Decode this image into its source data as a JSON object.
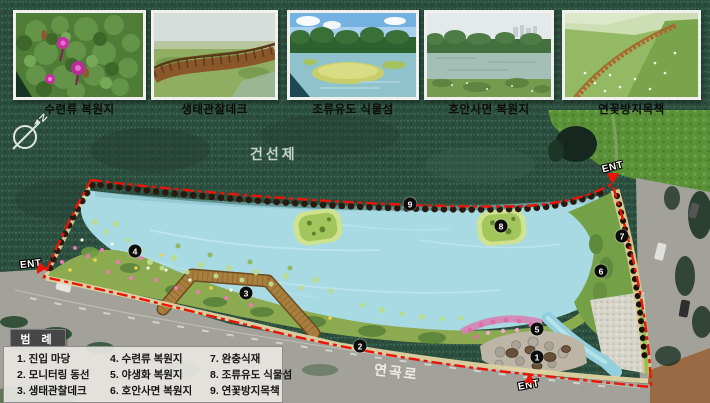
{
  "photos": [
    {
      "caption": "수련류 복원지"
    },
    {
      "caption": "생태관찰데크"
    },
    {
      "caption": "조류유도 식물섬"
    },
    {
      "caption": "호안사면 복원지"
    },
    {
      "caption": "연꽃방지목책"
    }
  ],
  "map": {
    "area_label": "건선제",
    "road_label": "연곡로",
    "entrance_label": "ENT",
    "compass_n": "N",
    "markers": [
      "1",
      "2",
      "3",
      "4",
      "5",
      "6",
      "7",
      "8",
      "9"
    ]
  },
  "legend": {
    "title": "범 례",
    "items": [
      "1. 진입 마당",
      "2. 모니터링 동선",
      "3. 생태관찰데크",
      "4. 수련류 복원지",
      "5. 야생화 복원지",
      "6. 호안사면 복원지",
      "7. 완충식재",
      "8. 조류유도 식물섬",
      "9. 연꽃방지목책"
    ]
  },
  "colors": {
    "boundary_red": "#ea1508",
    "lake_blue": "#a7dae3",
    "forest_green": "#2c4e3e",
    "field_green": "#5a9038",
    "shore_green": "#8cab50",
    "marker_black": "#0c0c0c",
    "legend_bg": "#e5e4df"
  }
}
